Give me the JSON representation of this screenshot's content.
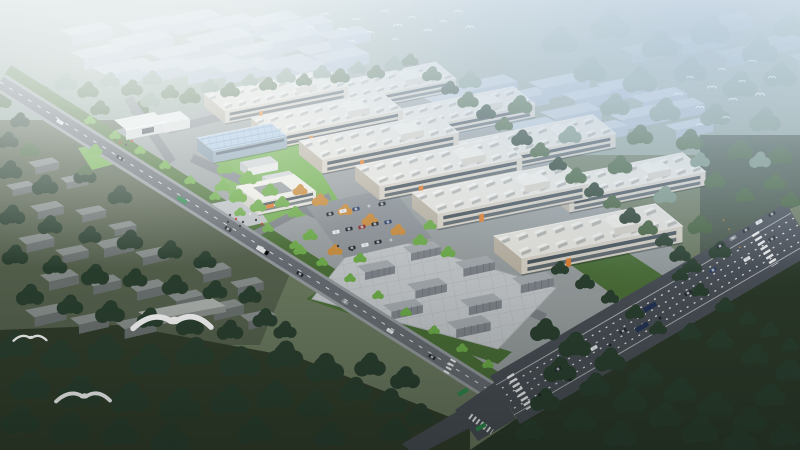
{
  "scene": {
    "label": "Aerial architectural rendering of an industrial park at dusk",
    "factory_count": 10,
    "blue_roof_workshop_count": 1,
    "gate_building_count": 1,
    "courtyard_office_count": 1,
    "container_cluster_count": 8,
    "bird_flock_count": 2,
    "large_gull_count": 3
  },
  "palette": {
    "land_base": "#6e7c62",
    "north_ground": "#93a49a",
    "field_dark": "#333e2c",
    "field_darker": "#2c3a2a",
    "village_ground": "#57624e",
    "park_ground": "#9ba1a2",
    "tree_dark": "#2b4030",
    "tree_mid": "#47633f",
    "tree_hazy": "#7c9584",
    "tree_bright": "#6fae4a",
    "tree_autumn": "#cc8e3e",
    "lawn": "#76b254",
    "lawn_dark": "#4c7038",
    "roof_white": "#e9e7e0",
    "roof_unit": "#f6f5f1",
    "roof_unit_shadow": "#b5b6b2",
    "facade": "#d9d3c7",
    "facade_dark": "#bdb5a6",
    "window": "#47525a",
    "blue_roof": "#b3cce6",
    "blue_roof_line": "#85a9cd",
    "blue_facade": "#91a7b8",
    "office_white": "#f2f1ea",
    "orange_accent": "#e2802f",
    "distant_bld": "#c8d3e1",
    "distant_bld_side": "#aebcd0",
    "road": "#686e74",
    "road_main": "#4a4f57",
    "road_mark": "#ffffff",
    "sidewalk": "#989da1",
    "internal_road": "#7e8489",
    "yard": "#c7cbce",
    "yard_line": "#b2b6ba",
    "container": "#a9aeb3",
    "container_side": "#82878e",
    "village_top": "#8c9290",
    "village_side": "#6d7372",
    "plaza": "#c3c7ca",
    "car_dark": "#23292f",
    "truck_green": "#2f8a4e",
    "bird_white": "#ffffff",
    "haze_white": "#eef4f8",
    "haze_blue": "#a9c3dc"
  }
}
